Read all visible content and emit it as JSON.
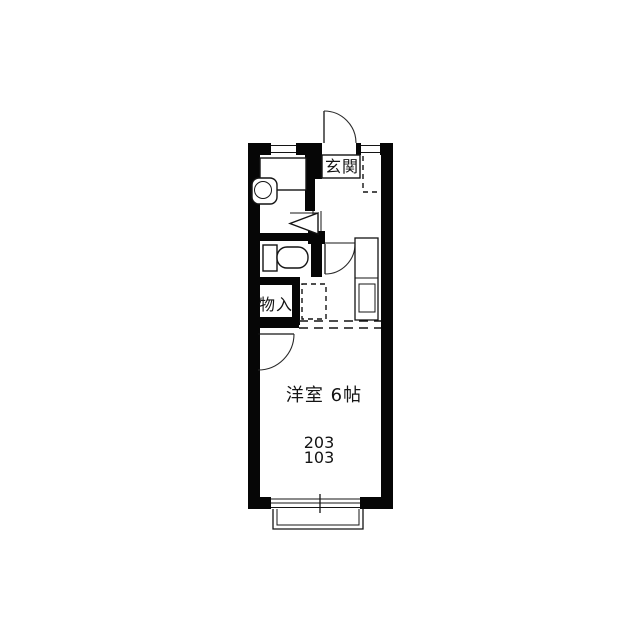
{
  "floorplan": {
    "title": "apartment-floor-plan",
    "labels": {
      "entrance": "玄関",
      "storage": "物入",
      "main_room": "洋室 6帖",
      "unit_number_upper": "203",
      "unit_number_lower": "103"
    },
    "colors": {
      "wall": "#060606",
      "background": "#ffffff",
      "line": "#141414"
    }
  }
}
